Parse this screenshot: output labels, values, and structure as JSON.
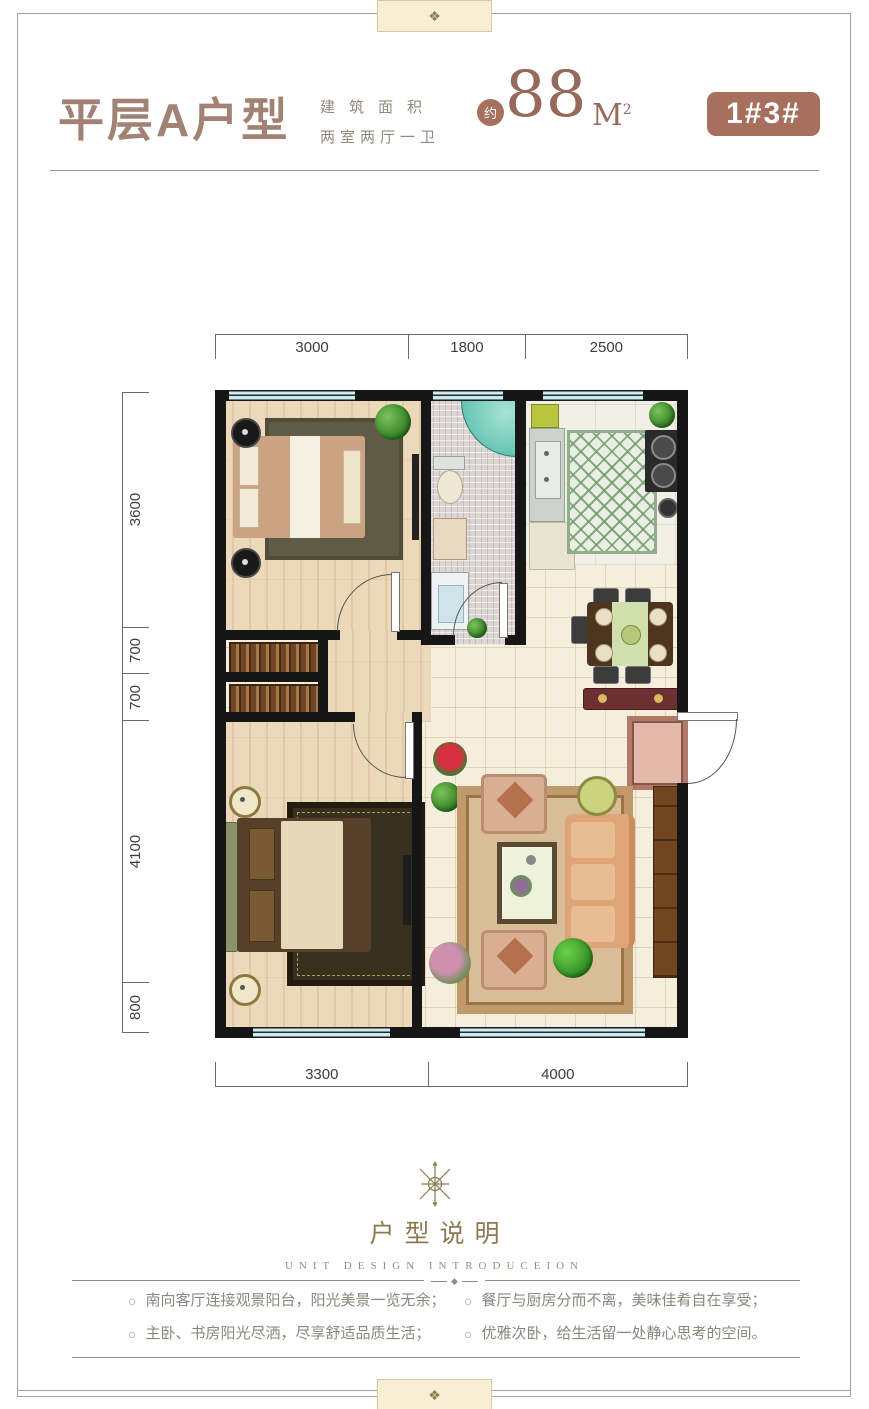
{
  "page": {
    "bg": "#ffffff",
    "frame_color": "#aaa29a"
  },
  "ornaments": {
    "finial": "❖",
    "note_divider": "◆"
  },
  "header": {
    "title": "平层A户型",
    "area_label_1": "建筑面积",
    "area_label_2": "两室两厅一卫",
    "approx": "约",
    "area_value": "88",
    "area_unit": "M",
    "area_unit_exp": "2",
    "badge": "1#3#",
    "accent_color": "#a7705e",
    "title_color": "#a28274"
  },
  "plan": {
    "dims_top": [
      "3000",
      "1800",
      "2500"
    ],
    "dims_left": [
      "3600",
      "700",
      "700",
      "4100",
      "800"
    ],
    "dims_bottom": [
      "3300",
      "4000"
    ]
  },
  "legend": {
    "title": "户型说明",
    "subtitle": "UNIT DESIGN INTRODUCEION"
  },
  "notes": {
    "marker": "○",
    "left": [
      "南向客厅连接观景阳台，阳光美景一览无余；",
      "主卧、书房阳光尽洒，尽享舒适品质生活；"
    ],
    "right": [
      "餐厅与厨房分而不离，美味佳肴自在享受；",
      "优雅次卧，给生活留一处静心思考的空间。"
    ]
  }
}
